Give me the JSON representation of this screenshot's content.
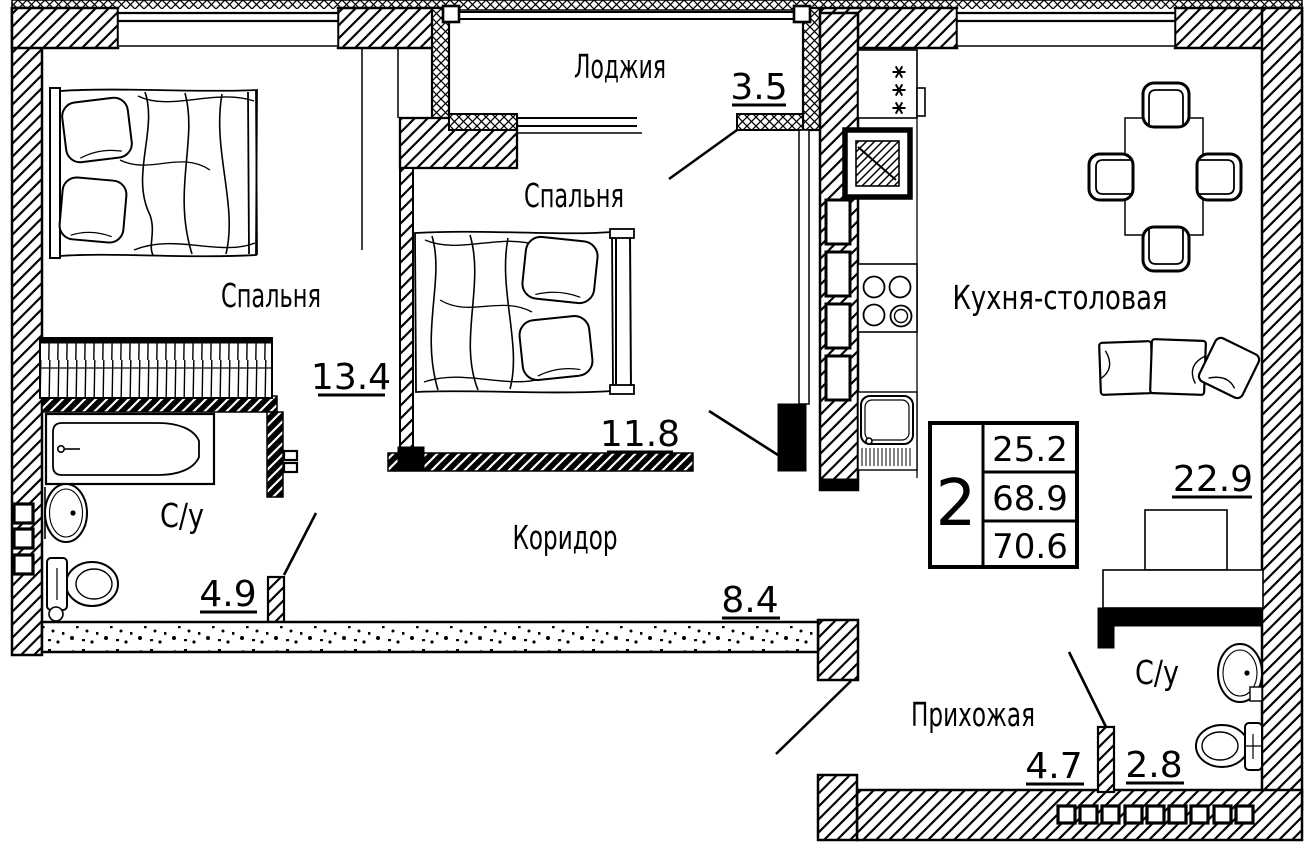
{
  "plan": {
    "rooms": {
      "loggia": {
        "label": "Лоджия",
        "area": "3.5"
      },
      "bedroom1": {
        "label": "Спальня",
        "area": "13.4"
      },
      "bedroom2": {
        "label": "Спальня",
        "area": "11.8"
      },
      "kitchen": {
        "label": "Кухня-столовая",
        "area": "22.9"
      },
      "bathroom1": {
        "label": "С/у",
        "area": "4.9"
      },
      "corridor": {
        "label": "Коридор",
        "area": "8.4"
      },
      "hallway": {
        "label": "Прихожая",
        "area": "4.7"
      },
      "bathroom2": {
        "label": "С/у",
        "area": "2.8"
      }
    },
    "stamp": {
      "rooms_count": "2",
      "living_area": "25.2",
      "apartment_area": "68.9",
      "total_area": "70.6"
    },
    "colors": {
      "ink": "#000000",
      "paper": "#ffffff"
    }
  }
}
